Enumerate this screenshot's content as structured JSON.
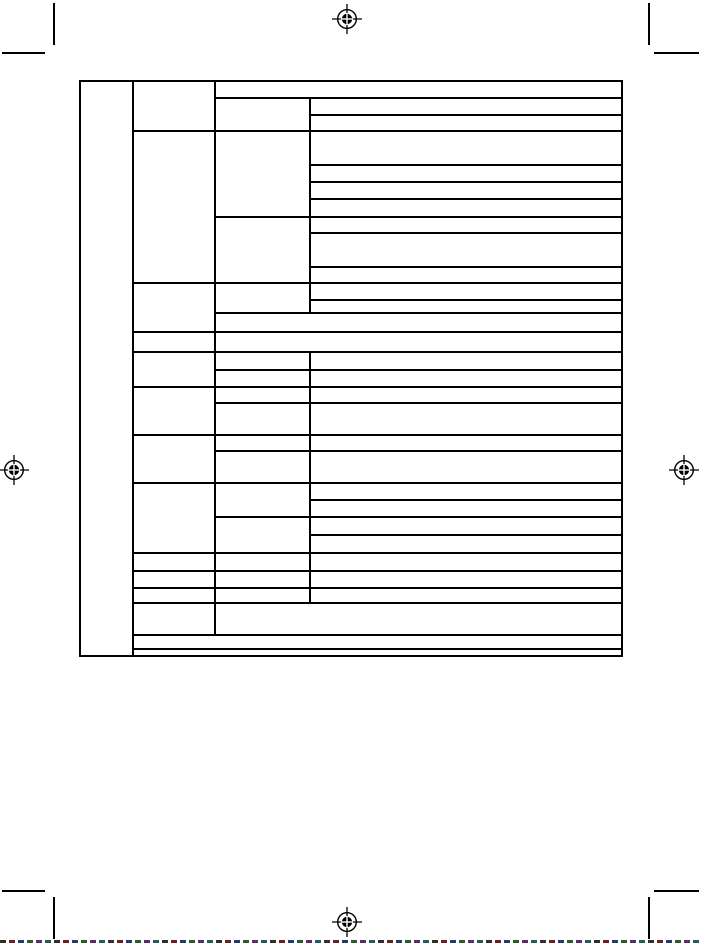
{
  "document": {
    "background": "#ffffff",
    "ink": "#000000",
    "kind": "blank-specifications-table-grid",
    "aria": "Print-ready manual page: empty nested specification table with crop marks, registration marks and tear-off line",
    "visible_text": ""
  },
  "table": {
    "x": 80,
    "y": 81,
    "right": 622,
    "bottom": 656,
    "line_width": 2,
    "columns_x": [
      80,
      133,
      215,
      310,
      622
    ],
    "h_lines": [
      {
        "y": 81,
        "x1": 80,
        "x2": 622
      },
      {
        "y": 98,
        "x1": 215,
        "x2": 622
      },
      {
        "y": 115,
        "x1": 310,
        "x2": 622
      },
      {
        "y": 131,
        "x1": 133,
        "x2": 622
      },
      {
        "y": 165,
        "x1": 310,
        "x2": 622
      },
      {
        "y": 182,
        "x1": 310,
        "x2": 622
      },
      {
        "y": 199,
        "x1": 310,
        "x2": 622
      },
      {
        "y": 217,
        "x1": 215,
        "x2": 622
      },
      {
        "y": 233,
        "x1": 310,
        "x2": 622
      },
      {
        "y": 267,
        "x1": 310,
        "x2": 622
      },
      {
        "y": 283,
        "x1": 133,
        "x2": 622
      },
      {
        "y": 300,
        "x1": 310,
        "x2": 622
      },
      {
        "y": 313,
        "x1": 215,
        "x2": 622
      },
      {
        "y": 332,
        "x1": 133,
        "x2": 622
      },
      {
        "y": 352,
        "x1": 133,
        "x2": 622
      },
      {
        "y": 370,
        "x1": 215,
        "x2": 622
      },
      {
        "y": 387,
        "x1": 133,
        "x2": 622
      },
      {
        "y": 403,
        "x1": 215,
        "x2": 622
      },
      {
        "y": 435,
        "x1": 133,
        "x2": 622
      },
      {
        "y": 451,
        "x1": 215,
        "x2": 622
      },
      {
        "y": 483,
        "x1": 133,
        "x2": 622
      },
      {
        "y": 500,
        "x1": 310,
        "x2": 622
      },
      {
        "y": 517,
        "x1": 215,
        "x2": 622
      },
      {
        "y": 535,
        "x1": 310,
        "x2": 622
      },
      {
        "y": 553,
        "x1": 133,
        "x2": 622
      },
      {
        "y": 571,
        "x1": 133,
        "x2": 622
      },
      {
        "y": 588,
        "x1": 133,
        "x2": 622
      },
      {
        "y": 603,
        "x1": 133,
        "x2": 622
      },
      {
        "y": 635,
        "x1": 133,
        "x2": 622
      },
      {
        "y": 649,
        "x1": 133,
        "x2": 622
      },
      {
        "y": 656,
        "x1": 80,
        "x2": 622
      }
    ],
    "v_lines": [
      {
        "x": 80,
        "y1": 81,
        "y2": 656
      },
      {
        "x": 133,
        "y1": 81,
        "y2": 656
      },
      {
        "x": 215,
        "y1": 81,
        "y2": 635
      },
      {
        "x": 310,
        "y1": 98,
        "y2": 313
      },
      {
        "x": 310,
        "y1": 352,
        "y2": 603
      },
      {
        "x": 622,
        "y1": 81,
        "y2": 656
      }
    ]
  },
  "registration_marks": {
    "positions": [
      {
        "x": 347,
        "y": 19
      },
      {
        "x": 14,
        "y": 470
      },
      {
        "x": 684,
        "y": 470
      },
      {
        "x": 347,
        "y": 922
      }
    ]
  },
  "crop_marks": [
    {
      "corner": "top-left",
      "dir": "v",
      "x": 53,
      "y": 3,
      "length": 42
    },
    {
      "corner": "top-left",
      "dir": "h",
      "x": 2,
      "y": 52,
      "length": 43
    },
    {
      "corner": "top-right",
      "dir": "v",
      "x": 648,
      "y": 3,
      "length": 42
    },
    {
      "corner": "top-right",
      "dir": "h",
      "x": 654,
      "y": 52,
      "length": 45
    },
    {
      "corner": "bottom-left",
      "dir": "h",
      "x": 2,
      "y": 890,
      "length": 43
    },
    {
      "corner": "bottom-left",
      "dir": "v",
      "x": 53,
      "y": 897,
      "length": 42
    },
    {
      "corner": "bottom-right",
      "dir": "h",
      "x": 654,
      "y": 890,
      "length": 45
    },
    {
      "corner": "bottom-right",
      "dir": "v",
      "x": 648,
      "y": 897,
      "length": 42
    }
  ],
  "tear_line": {
    "y": 940,
    "height": 3,
    "dash_px": 6,
    "gap_px": 3,
    "colors": [
      "#303030",
      "#6e1f1f",
      "#1f3c6e",
      "#2a5c2a",
      "#5e2a6e",
      "#1f5e5e"
    ]
  }
}
